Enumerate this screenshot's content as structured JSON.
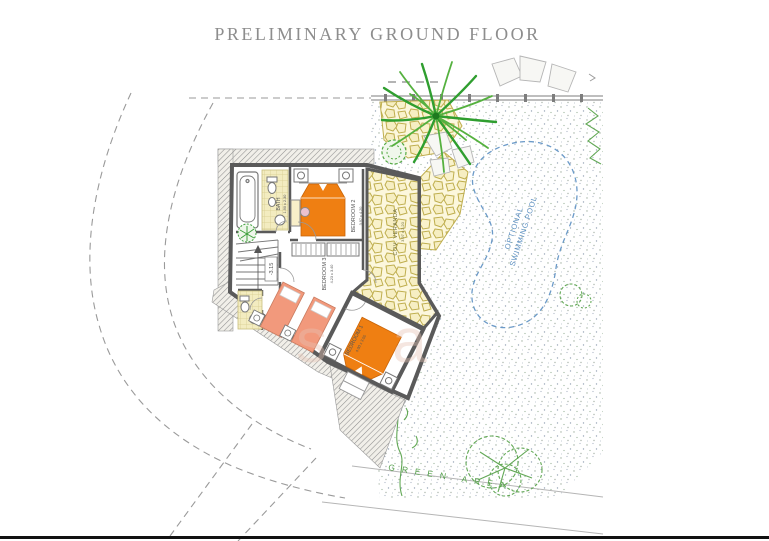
{
  "title": "PRELIMINARY GROUND FLOOR",
  "colors": {
    "title_gray": "#8d8d8d",
    "wall_gray": "#5a5a5a",
    "bed_orange": "#ef7f12",
    "bed_salmon": "#f2997c",
    "pool_blue": "#5b8fc0",
    "plant_green": "#3fa03c",
    "stone_fill": "#f6eec2",
    "stone_outline": "#bfae4e"
  },
  "plan": {
    "level_label": "-3.15",
    "pool_label_line1": "OPTIONAL",
    "pool_label_line2": "SWIMMING POOL",
    "green_area_label": "GREEN AREA",
    "watermark": "s a",
    "rooms": {
      "bath": {
        "name": "BATH",
        "dims": "1.90 x 2.30"
      },
      "bedroom2": {
        "name": "BEDROOM 2",
        "dims": "3.97 x 4.20"
      },
      "bedroom3": {
        "name": "BEDROOM 3",
        "dims": "4.23 x 3.40"
      },
      "bedroom1": {
        "name": "BEDROOM 1",
        "dims": "4.00 x 3.55"
      },
      "veranda": {
        "name": "COV. VERANDA",
        "dims": "3.97 x 2.20"
      }
    }
  }
}
